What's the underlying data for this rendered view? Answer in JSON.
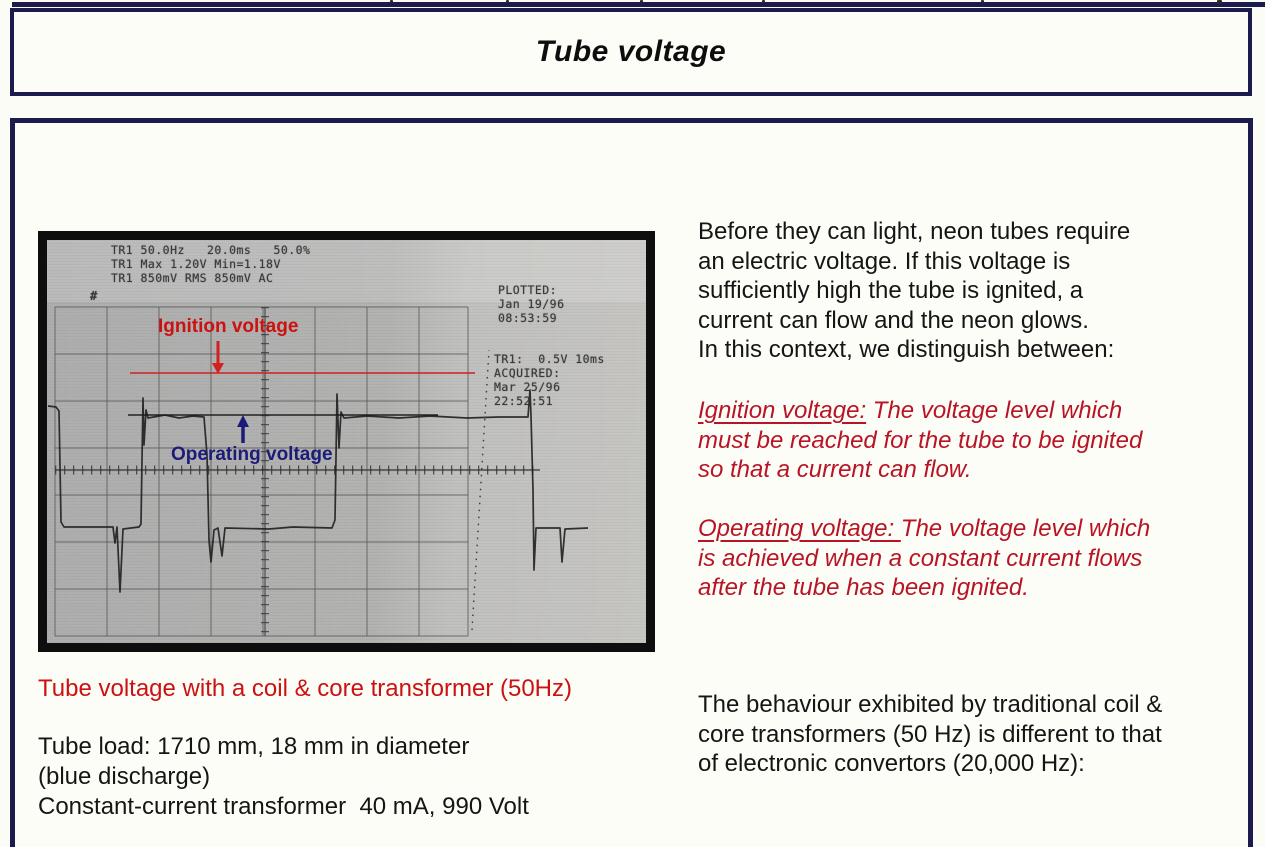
{
  "colors": {
    "border_navy": "#1b1b4e",
    "caption_red": "#cc1111",
    "definition_red": "#b81425",
    "operating_navy": "#1c1c78",
    "body_text": "#151515"
  },
  "title_box": {
    "title": "Tube voltage"
  },
  "scope_image": {
    "readout_lines": [
      "TR1 50.0Hz   20.0ms   50.0%",
      "TR1 Max 1.20V Min=1.18V",
      "TR1 850mV RMS 850mV AC"
    ],
    "hash_mark": "#",
    "plotted_lines": [
      "PLOTTED:",
      "Jan 19/96",
      "08:53:59"
    ],
    "acquired_lines": [
      "TR1:  0.5V 10ms",
      "ACQUIRED:",
      "Mar 25/96",
      "22:52:51"
    ],
    "ignition_label": "Ignition voltage",
    "operating_label": "Operating voltage"
  },
  "left_column": {
    "caption": "Tube voltage with a coil & core transformer (50Hz)",
    "detail_lines": [
      "Tube load: 1710 mm, 18 mm in diameter",
      "(blue discharge)",
      "Constant-current transformer  40 mA, 990 Volt"
    ]
  },
  "right_column": {
    "intro_lines": [
      "Before they can light, neon tubes require",
      "an electric voltage. If this voltage is",
      "sufficiently high the tube is ignited, a",
      "current can flow and the neon glows.",
      "In this context, we distinguish between:"
    ],
    "ignition_term": "Ignition voltage:",
    "ignition_rest_lines": [
      " The voltage level which",
      "must be reached for the tube to be ignited",
      "so that a current can flow."
    ],
    "operating_term": "Operating voltage: ",
    "operating_rest_lines": [
      "The voltage level which",
      "is achieved when a constant current flows",
      "after the tube has been ignited."
    ],
    "closing_lines": [
      "The behaviour exhibited by traditional coil &",
      "core transformers (50 Hz) is different to that",
      "of electronic convertors (20,000 Hz):"
    ]
  }
}
